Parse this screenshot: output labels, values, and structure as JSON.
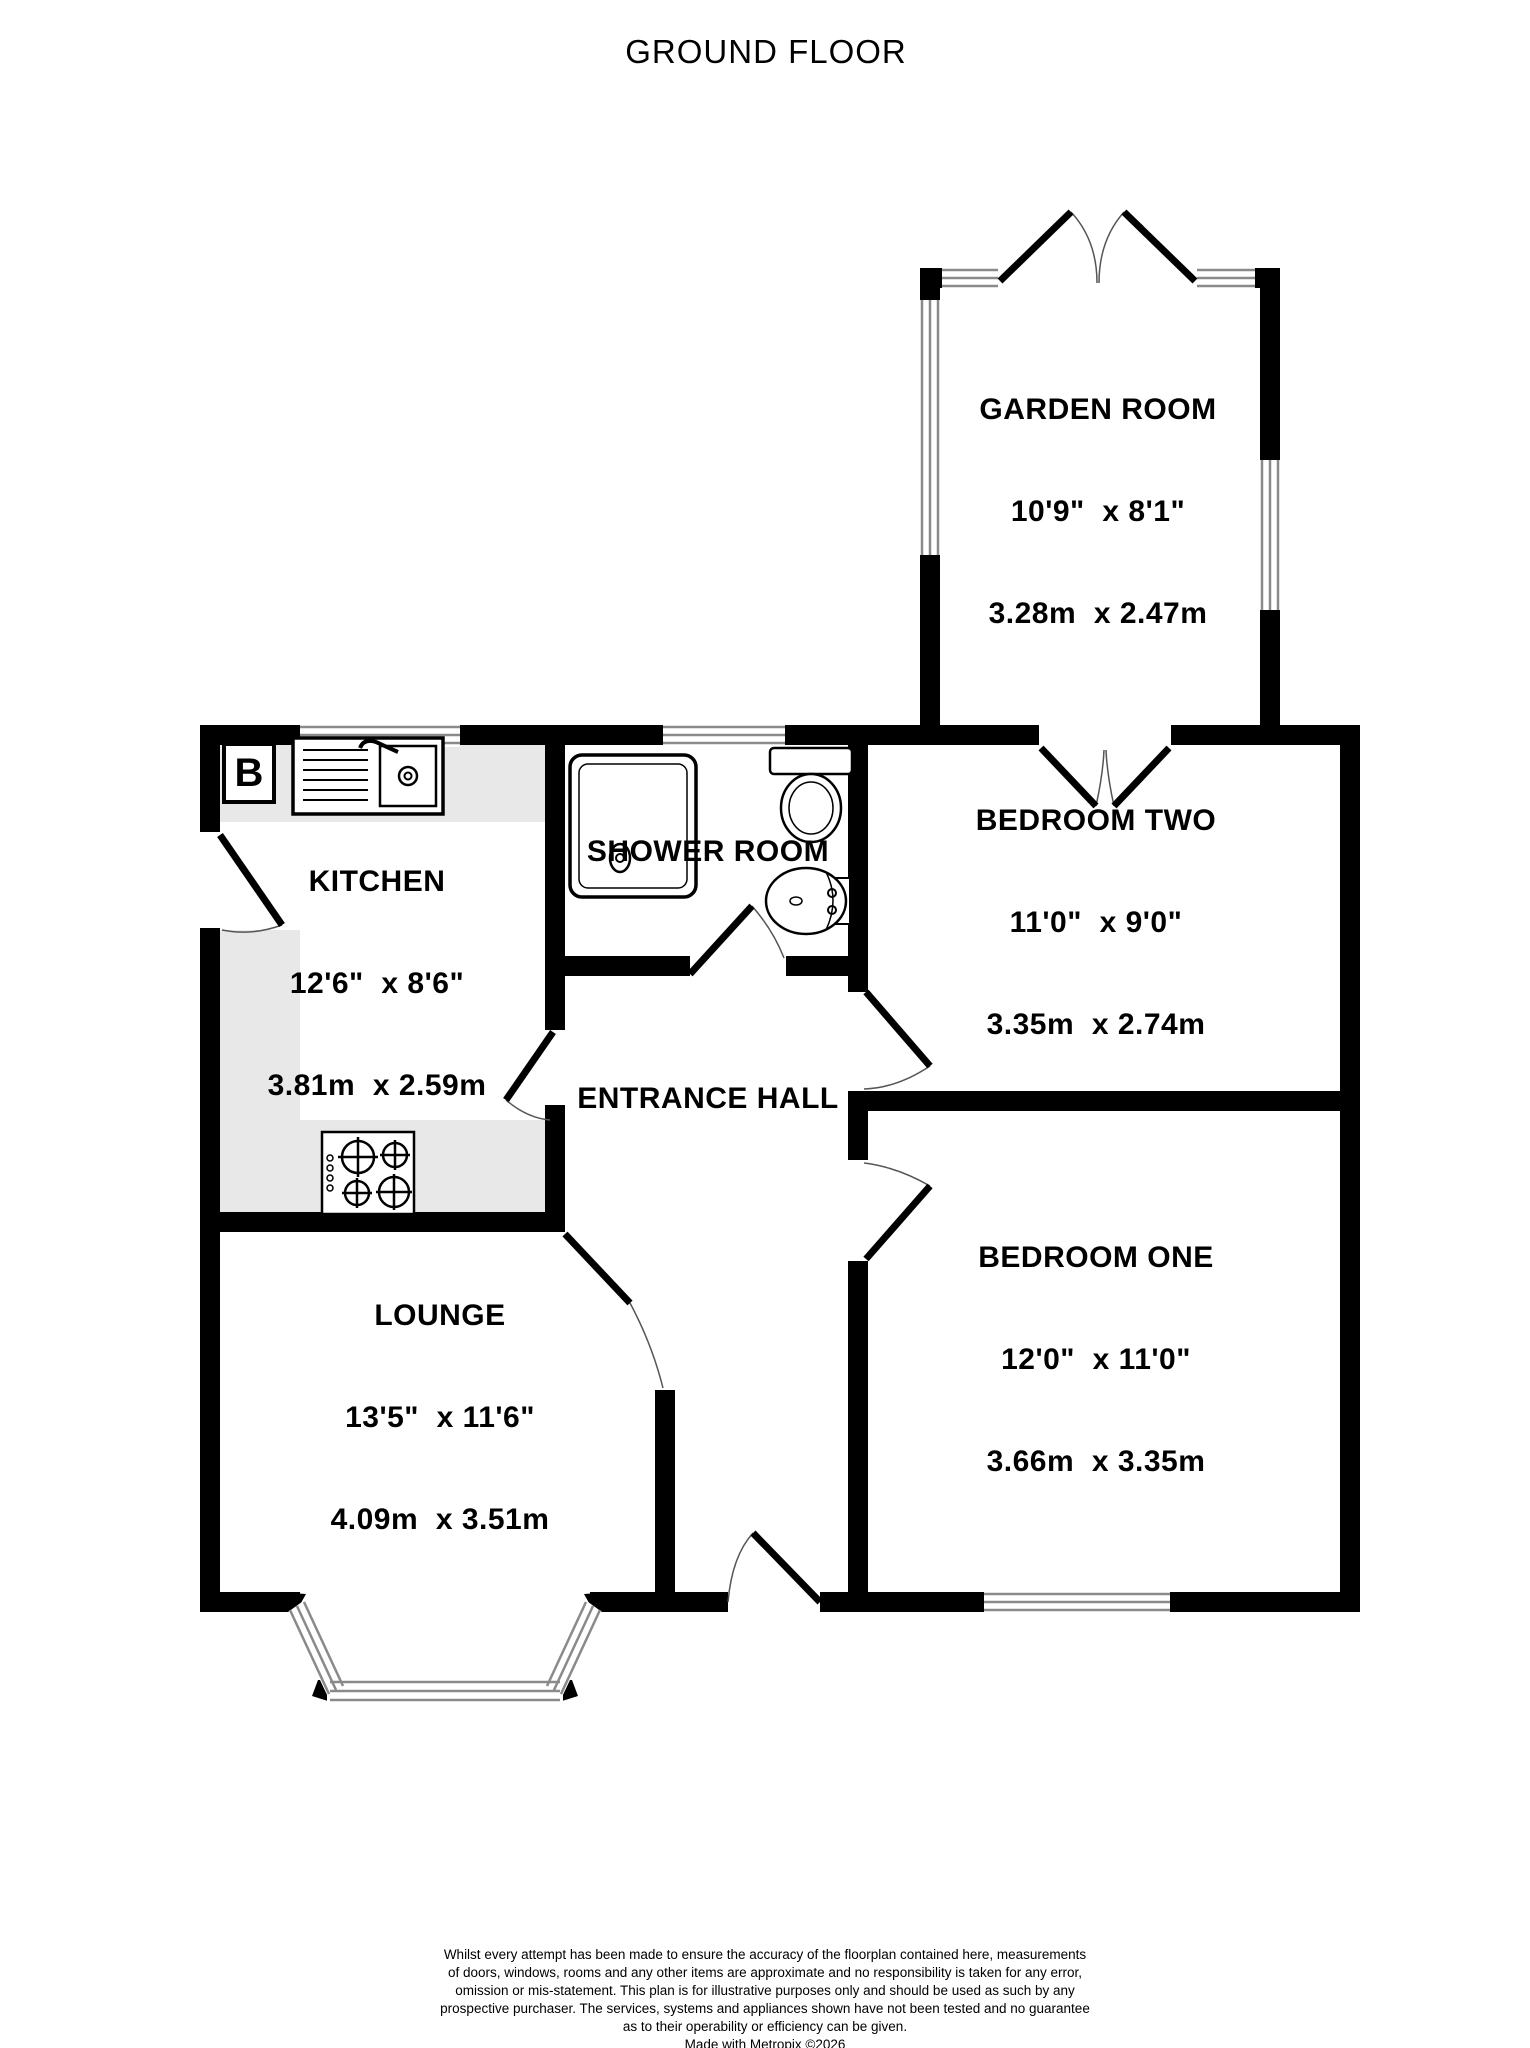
{
  "page": {
    "title": "GROUND FLOOR"
  },
  "rooms": [
    {
      "id": "garden-room",
      "name": "GARDEN ROOM",
      "imperial": "10'9\"  x 8'1\"",
      "metric": "3.28m  x 2.47m"
    },
    {
      "id": "bedroom-two",
      "name": "BEDROOM TWO",
      "imperial": "11'0\"  x 9'0\"",
      "metric": "3.35m  x 2.74m"
    },
    {
      "id": "kitchen",
      "name": "KITCHEN",
      "imperial": "12'6\"  x 8'6\"",
      "metric": "3.81m  x 2.59m"
    },
    {
      "id": "shower-room",
      "name": "SHOWER ROOM"
    },
    {
      "id": "entrance-hall",
      "name": "ENTRANCE HALL"
    },
    {
      "id": "bedroom-one",
      "name": "BEDROOM ONE",
      "imperial": "12'0\"  x 11'0\"",
      "metric": "3.66m  x 3.35m"
    },
    {
      "id": "lounge",
      "name": "LOUNGE",
      "imperial": "13'5\"  x 11'6\"",
      "metric": "4.09m  x 3.51m"
    }
  ],
  "labels": {
    "boiler": "B"
  },
  "disclaimer": {
    "lines": [
      "Whilst every attempt has been made to ensure the accuracy of the floorplan contained here, measurements",
      "of doors, windows, rooms and any other items are approximate and no responsibility is taken for any error,",
      "omission or mis-statement. This plan is for illustrative purposes only and should be used as such by any",
      "prospective purchaser. The services, systems and appliances shown have not been tested and no guarantee",
      "as to their operability or efficiency can be given.",
      "Made with Metropix ©2026"
    ]
  },
  "colors": {
    "wall": "#000000",
    "counter": "#e8e8e8",
    "window_line": "#8a8a8a",
    "door_arc": "#555555"
  }
}
